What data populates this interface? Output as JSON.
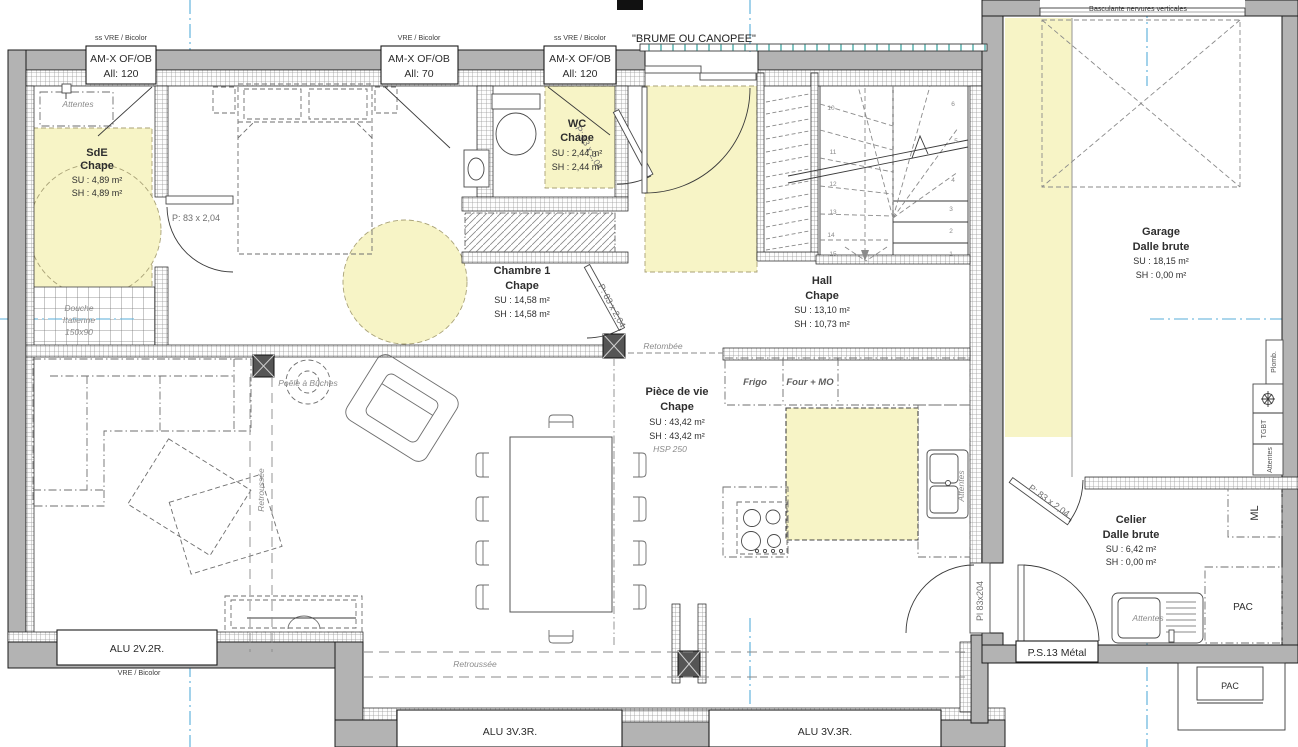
{
  "rooms": {
    "sde": {
      "name": "SdE",
      "floor": "Chape",
      "su": "SU : 4,89 m²",
      "sh": "SH : 4,89 m²"
    },
    "chambre1": {
      "name": "Chambre 1",
      "floor": "Chape",
      "su": "SU : 14,58 m²",
      "sh": "SH : 14,58 m²"
    },
    "wc": {
      "name": "WC",
      "floor": "Chape",
      "su": "SU : 2,44 m²",
      "sh": "SH : 2,44 m²"
    },
    "hall": {
      "name": "Hall",
      "floor": "Chape",
      "su": "SU : 13,10 m²",
      "sh": "SH : 10,73 m²"
    },
    "piece_de_vie": {
      "name": "Pièce de vie",
      "floor": "Chape",
      "su": "SU : 43,42 m²",
      "sh": "SH : 43,42 m²",
      "hsp": "HSP 250"
    },
    "garage": {
      "name": "Garage",
      "floor": "Dalle brute",
      "su": "SU : 18,15 m²",
      "sh": "SH : 0,00 m²"
    },
    "celier": {
      "name": "Celier",
      "floor": "Dalle brute",
      "su": "SU : 6,42 m²",
      "sh": "SH : 0,00 m²"
    }
  },
  "openings": {
    "window_sde": {
      "line1": "AM-X OF/OB",
      "line2": "All:  120",
      "tag": "ss VRE / Bicolor"
    },
    "window_chambre": {
      "line1": "AM-X OF/OB",
      "line2": "All:  70",
      "tag": "VRE / Bicolor"
    },
    "window_wc": {
      "line1": "AM-X OF/OB",
      "line2": "All:  120",
      "tag": "ss VRE / Bicolor"
    },
    "bay_entry": {
      "label": "\"BRUME OU CANOPEE\""
    },
    "garage_door": {
      "label": "Basculante nervures verticales"
    },
    "window_salon": {
      "label": "ALU 2V.2R.",
      "tag": "VRE / Bicolor"
    },
    "window_south_left": {
      "label": "ALU 3V.3R."
    },
    "window_south_right": {
      "label": "ALU 3V.3R."
    },
    "door_service": {
      "label": "P.S.13 Métal"
    },
    "door_interior_label": "P: 83 x 2,04",
    "door_garage_label": "Pl 83x204"
  },
  "annotations": {
    "attentes": "Attentes",
    "douche_line1": "Douche",
    "douche_line2": "Italienne",
    "douche_line3": "150x90",
    "poele": "Poêle à Bûches",
    "retroussee": "Retroussée",
    "retombee": "Retombée",
    "frigo": "Frigo",
    "four_mo": "Four + MO",
    "plomb": "Plomb.",
    "tgbt": "TGBT",
    "ml": "ML",
    "pac": "PAC"
  },
  "stairs": {
    "right_steps": [
      "1",
      "2",
      "3",
      "4",
      "5",
      "6"
    ],
    "left_steps": [
      "10",
      "11",
      "12",
      "13",
      "14",
      "15"
    ]
  },
  "colors": {
    "wall_fill": "#b3b3b3",
    "highlight": "#f7f4c6",
    "axis_blue": "#57aeda",
    "canopy_tick": "#2f9e98"
  }
}
